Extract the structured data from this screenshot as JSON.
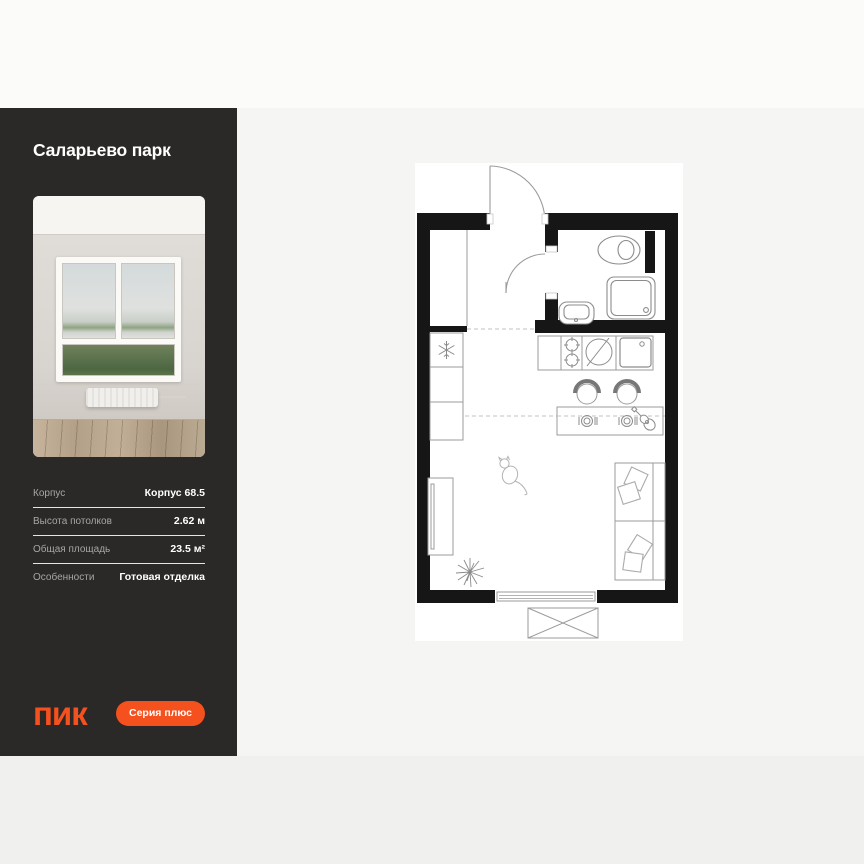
{
  "sidebar": {
    "project_title": "Саларьево парк",
    "specs": [
      {
        "label": "Корпус",
        "value": "Корпус 68.5"
      },
      {
        "label": "Высота потолков",
        "value": "2.62 м"
      },
      {
        "label": "Общая площадь",
        "value": "23.5 м²"
      },
      {
        "label": "Особенности",
        "value": "Готовая отделка"
      }
    ],
    "logo_text": "ПИК",
    "series_badge": "Серия плюс"
  },
  "floor_plan": {
    "type": "studio-apartment-plan",
    "features": [
      "entrance-door",
      "hall-closet",
      "bathroom",
      "toilet",
      "washbasin",
      "shower-cabin",
      "ventilation-shaft",
      "fridge",
      "kitchen-cabinets",
      "stove",
      "kitchen-sink",
      "bar-counter",
      "bar-stools",
      "place-settings",
      "guitar",
      "sofa-bed",
      "pillows",
      "tv-unit",
      "plant",
      "cat",
      "window",
      "balcony-unit"
    ]
  },
  "colors": {
    "accent": "#F4511E",
    "sidebar_bg": "#2A2927",
    "panel_bg": "#F5F5F3",
    "top_bar": "#FBFBF9",
    "bottom_bar": "#F0F0EE",
    "wall": "#161616"
  }
}
